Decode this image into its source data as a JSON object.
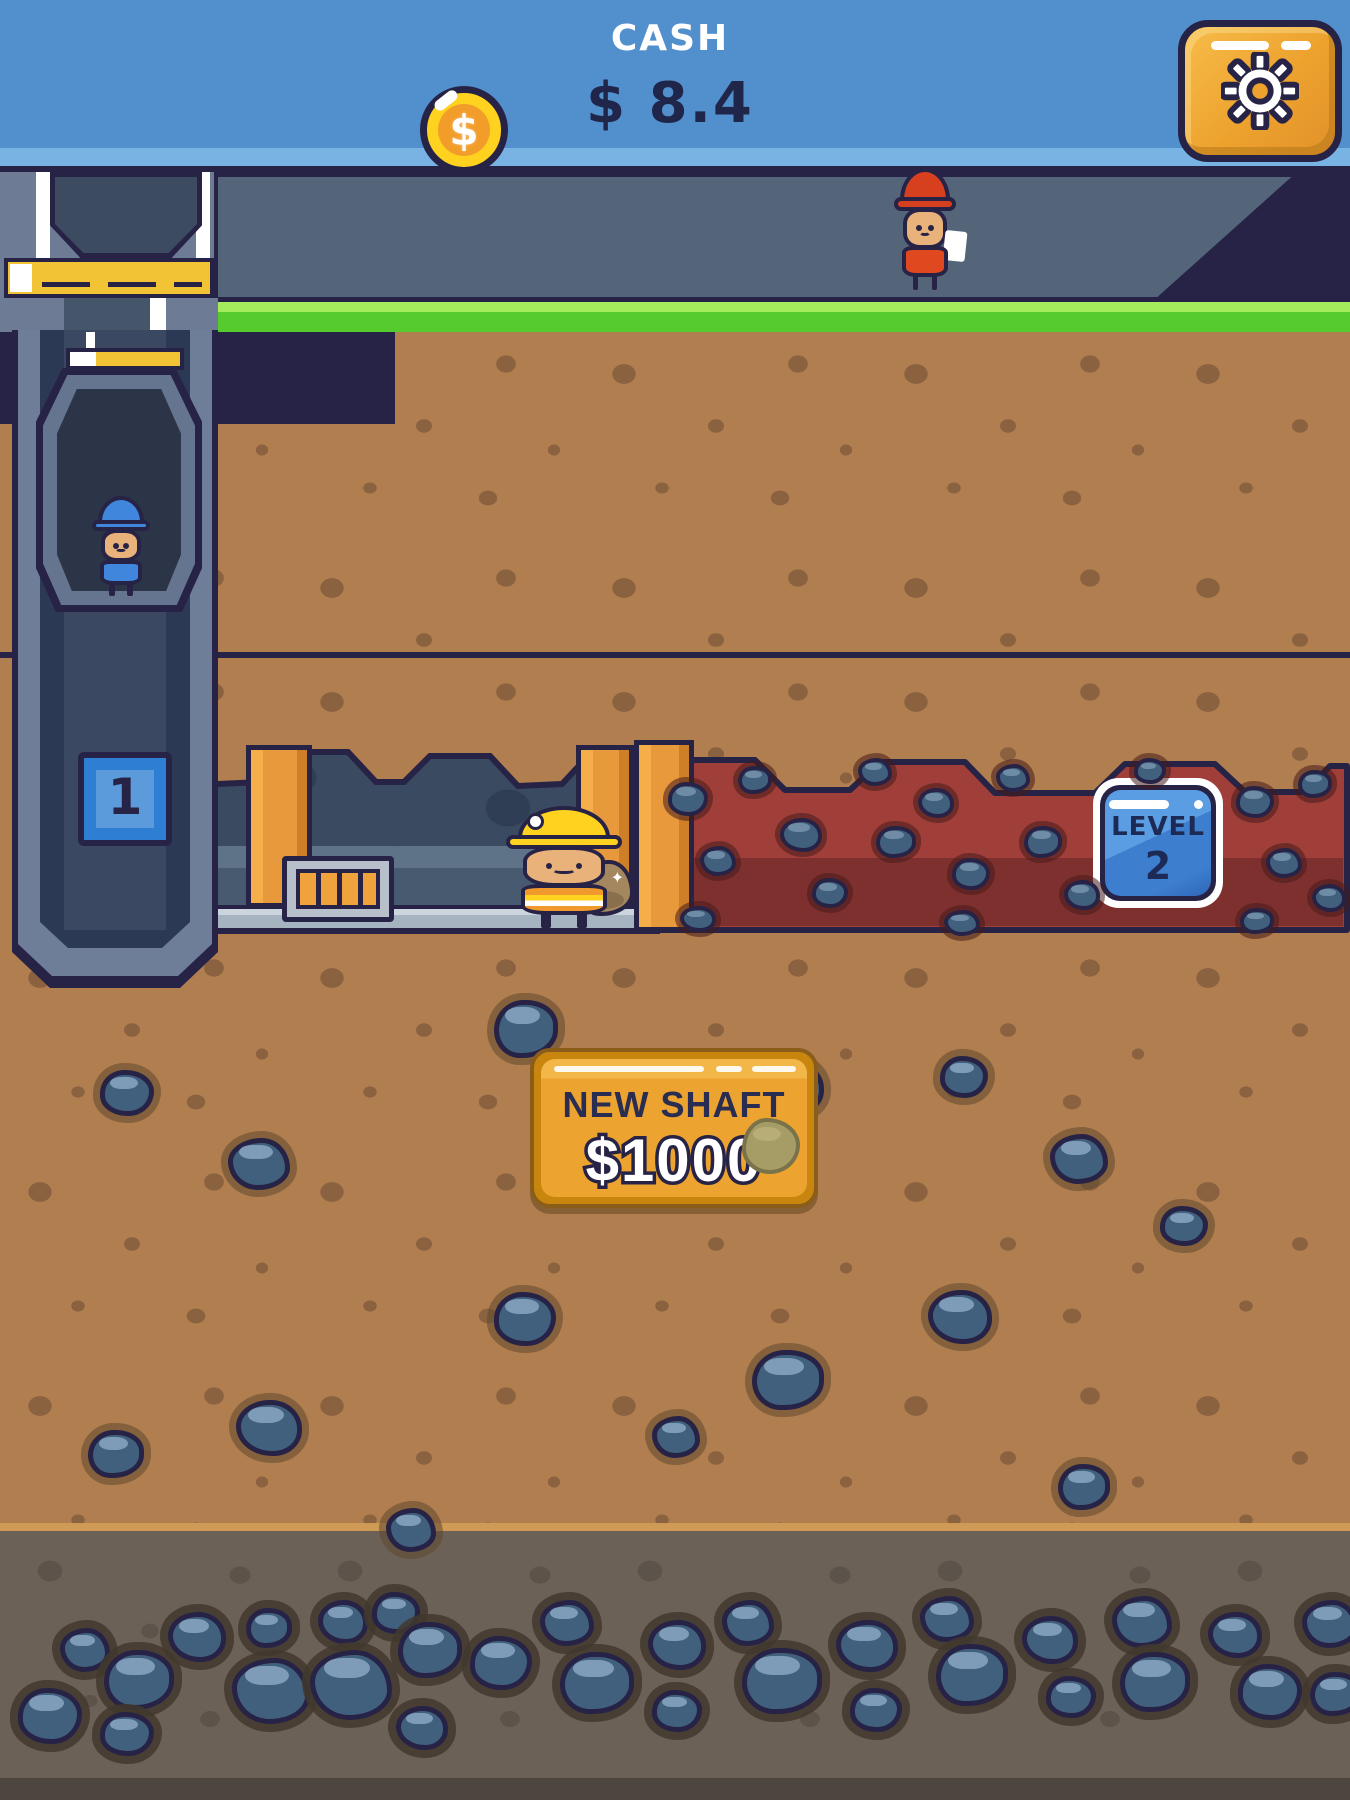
{
  "header": {
    "cash_label": "CASH",
    "cash_amount": "$ 8.4",
    "coin_symbol": "$"
  },
  "elevator": {
    "shaft_number": "1"
  },
  "ore_level": {
    "label": "LEVEL",
    "number": "2"
  },
  "new_shaft": {
    "label": "NEW SHAFT",
    "price": "$1000"
  },
  "colors": {
    "top_bar_blue": "#5190cd",
    "outline_navy": "#272346",
    "dirt_brown": "#b17e4f",
    "ore_red": "#a03e3a",
    "button_orange": "#eda32f",
    "badge_blue": "#3d7ecf",
    "teal_hills": "#14b3a2",
    "coin_yellow": "#ffd21f",
    "rock_blue_gray": "#41607e"
  }
}
